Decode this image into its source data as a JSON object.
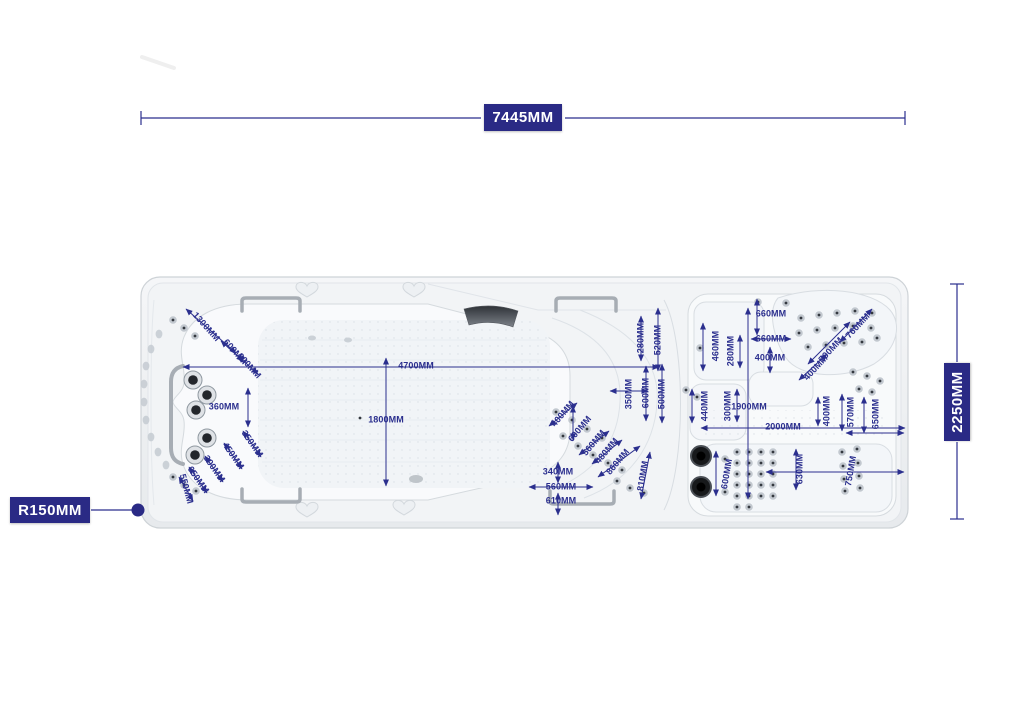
{
  "overall": {
    "length": "7445MM",
    "width": "2250MM",
    "corner_radius": "R150MM"
  },
  "colors": {
    "annotation": "#2b2f8e",
    "box_bg": "#2a2a85",
    "box_text": "#ffffff"
  },
  "dims": {
    "l1300": "1300MM",
    "l600": "600MM",
    "l300": "300MM",
    "l360": "360MM",
    "l350": "350MM",
    "l450": "450MM",
    "l300b": "300MM",
    "l650": "650MM",
    "l550": "550MM",
    "s4700": "4700MM",
    "s1800": "1800MM",
    "m280": "280MM",
    "m520": "520MM",
    "m350": "350MM",
    "m600": "600MM",
    "m500": "500MM",
    "c400": "400MM",
    "c600": "600MM",
    "c560": "560MM",
    "c480": "480MM",
    "c860": "860MM",
    "c810": "810MM",
    "b340": "340MM",
    "b560": "560MM",
    "b610": "610MM",
    "r660a": "660MM",
    "r660b": "660MM",
    "r400a": "400MM",
    "r460": "460MM",
    "r280": "280MM",
    "r760": "760MM",
    "r700": "700MM",
    "r400b": "400MM",
    "r440": "440MM",
    "r300": "300MM",
    "r1900": "1900MM",
    "r2000": "2000MM",
    "r400c": "400MM",
    "r570": "570MM",
    "r650": "650MM",
    "r600": "600MM",
    "r630": "630MM",
    "r750": "750MM"
  }
}
